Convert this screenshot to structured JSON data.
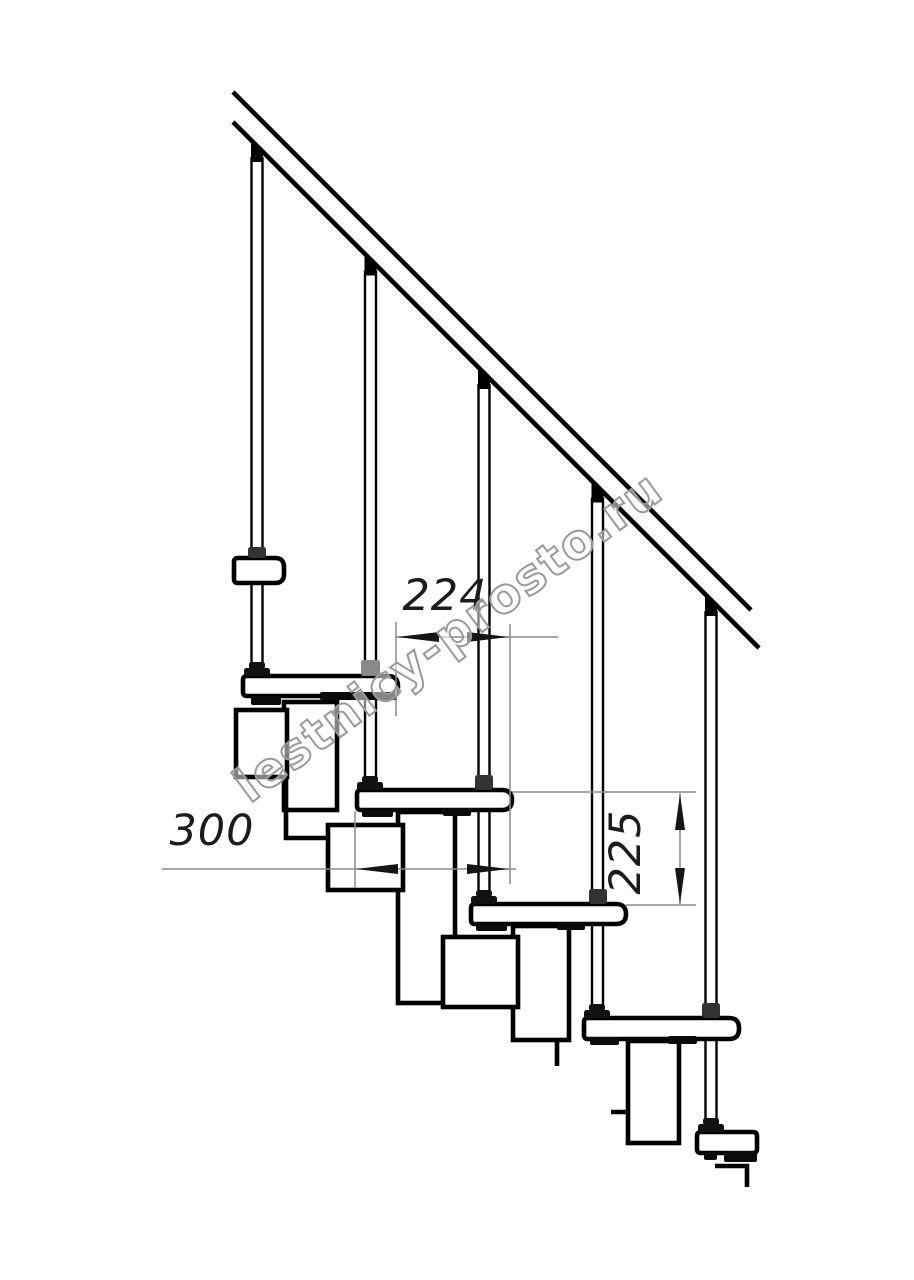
{
  "canvas": {
    "width": 914,
    "height": 1280,
    "background": "#ffffff",
    "ink": "#000000",
    "dim_line_color": "#8a8a8a",
    "dim_text_color": "#1c1c1c"
  },
  "watermark": {
    "text": "lestnicy-prosto.ru",
    "cx": 458,
    "cy": 650,
    "angle": -36.5,
    "font_size": 48,
    "stroke": "#9a9a9a",
    "fill": "#ffffff",
    "fill_opacity": 0.5
  },
  "handrail": {
    "upper_line": [
      233,
      92,
      751,
      610
    ],
    "lower_line": [
      233,
      122,
      759,
      648
    ],
    "stroke_width": 4.6
  },
  "balusters": [
    {
      "x": 257,
      "bottom": 676
    },
    {
      "x": 370.5,
      "bottom": 790
    },
    {
      "x": 484,
      "bottom": 904
    },
    {
      "x": 597.5,
      "bottom": 1018
    },
    {
      "x": 711,
      "bottom": 1132
    }
  ],
  "landing_plate": {
    "x": 234,
    "y": 558,
    "w": 50,
    "h": 25
  },
  "treads": [
    {
      "x": 243,
      "y": 676,
      "w": 155,
      "h": 20
    },
    {
      "x": 357,
      "y": 790,
      "w": 155,
      "h": 20
    },
    {
      "x": 471,
      "y": 904,
      "w": 155,
      "h": 20
    },
    {
      "x": 584,
      "y": 1018,
      "w": 155,
      "h": 21
    },
    {
      "x": 697,
      "y": 1132,
      "w": 60,
      "h": 21
    }
  ],
  "modules": [
    {
      "x": 284,
      "y": 702,
      "w": 53,
      "h": 108
    },
    {
      "x": 398,
      "y": 812,
      "w": 57,
      "h": 191
    },
    {
      "x": 513,
      "y": 926,
      "w": 56,
      "h": 114
    },
    {
      "x": 628,
      "y": 1041,
      "w": 51,
      "h": 102
    }
  ],
  "connectors": [
    {
      "x": 236,
      "y": 710,
      "w": 51,
      "h": 67
    },
    {
      "x": 328,
      "y": 825,
      "w": 75,
      "h": 65
    },
    {
      "x": 443,
      "y": 937,
      "w": 75,
      "h": 70
    }
  ],
  "polylines": [
    {
      "name": "upper-joint-step-line",
      "pts": [
        [
          286,
          777
        ],
        [
          286,
          838
        ],
        [
          330,
          838
        ]
      ]
    },
    {
      "name": "connector-3-left-line",
      "pts": [
        [
          557,
          1040
        ],
        [
          557,
          1066
        ]
      ]
    },
    {
      "name": "connector-3-bottom-line",
      "pts": [
        [
          630,
          1112
        ],
        [
          611,
          1112
        ]
      ]
    },
    {
      "name": "floor-step-line",
      "pts": [
        [
          715,
          1166
        ],
        [
          747,
          1166
        ],
        [
          747,
          1187
        ]
      ]
    }
  ],
  "tabs": [
    {
      "x": 251,
      "y": 696,
      "w": 30,
      "h": 9
    },
    {
      "x": 320,
      "y": 692,
      "w": 77,
      "h": 8
    },
    {
      "x": 362,
      "y": 809,
      "w": 31,
      "h": 8
    },
    {
      "x": 443,
      "y": 808,
      "w": 28,
      "h": 8
    },
    {
      "x": 476,
      "y": 923,
      "w": 31,
      "h": 8
    },
    {
      "x": 557,
      "y": 922,
      "w": 28,
      "h": 8
    },
    {
      "x": 590,
      "y": 1037,
      "w": 29,
      "h": 8
    },
    {
      "x": 668,
      "y": 1036,
      "w": 29,
      "h": 8
    },
    {
      "x": 704,
      "y": 1152,
      "w": 13,
      "h": 8
    },
    {
      "x": 724,
      "y": 1151,
      "w": 33,
      "h": 11
    }
  ],
  "collars": [
    {
      "kind": "collar",
      "x": 248,
      "y": 547,
      "w": 18,
      "h": 11,
      "c": "#333333"
    },
    {
      "kind": "flange",
      "x": 249,
      "y": 662,
      "w": 16,
      "h": 7,
      "c": "#111111"
    },
    {
      "kind": "flange",
      "x": 244,
      "y": 668,
      "w": 26,
      "h": 8,
      "c": "#111111"
    },
    {
      "kind": "collar",
      "x": 361,
      "y": 660,
      "w": 19,
      "h": 16,
      "c": "#898989"
    },
    {
      "kind": "flange",
      "x": 362,
      "y": 776,
      "w": 16,
      "h": 7,
      "c": "#111111"
    },
    {
      "kind": "flange",
      "x": 357,
      "y": 782,
      "w": 26,
      "h": 8,
      "c": "#111111"
    },
    {
      "kind": "collar",
      "x": 475,
      "y": 775,
      "w": 18,
      "h": 15,
      "c": "#333333"
    },
    {
      "kind": "flange",
      "x": 476,
      "y": 890,
      "w": 16,
      "h": 7,
      "c": "#111111"
    },
    {
      "kind": "flange",
      "x": 471,
      "y": 896,
      "w": 26,
      "h": 8,
      "c": "#111111"
    },
    {
      "kind": "collar",
      "x": 589,
      "y": 889,
      "w": 18,
      "h": 15,
      "c": "#333333"
    },
    {
      "kind": "flange",
      "x": 589,
      "y": 1004,
      "w": 16,
      "h": 7,
      "c": "#111111"
    },
    {
      "kind": "flange",
      "x": 584,
      "y": 1010,
      "w": 26,
      "h": 8,
      "c": "#111111"
    },
    {
      "kind": "collar",
      "x": 702,
      "y": 1003,
      "w": 18,
      "h": 15,
      "c": "#333333"
    },
    {
      "kind": "flange",
      "x": 703,
      "y": 1118,
      "w": 16,
      "h": 7,
      "c": "#111111"
    },
    {
      "kind": "flange",
      "x": 698,
      "y": 1124,
      "w": 26,
      "h": 8,
      "c": "#111111"
    }
  ],
  "dimensions": {
    "d224": {
      "label": "224",
      "label_pos": [
        445,
        610
      ],
      "ext_lines": [
        [
          396,
          622,
          396,
          716
        ],
        [
          510,
          624,
          510,
          884
        ]
      ],
      "dim_line": [
        396,
        637,
        558,
        637
      ],
      "arrows": [
        {
          "tip": [
            397,
            637
          ],
          "dir": "left"
        },
        {
          "tip": [
            509,
            637
          ],
          "dir": "right"
        }
      ]
    },
    "d300": {
      "label": "300",
      "label_pos": [
        212,
        845
      ],
      "ext_lines": [
        [
          355,
          811,
          355,
          888
        ]
      ],
      "dim_line": [
        162,
        869,
        516,
        869
      ],
      "arrows": [
        {
          "tip": [
            356,
            869
          ],
          "dir": "left"
        },
        {
          "tip": [
            509,
            869
          ],
          "dir": "right"
        }
      ]
    },
    "d225": {
      "label": "225",
      "label_pos": [
        640,
        852
      ],
      "label_rotation": -90,
      "ext_lines": [
        [
          512,
          792,
          696,
          792
        ],
        [
          626,
          905,
          696,
          905
        ]
      ],
      "dim_line": [
        680,
        793,
        680,
        904
      ],
      "arrows": [
        {
          "tip": [
            680,
            794
          ],
          "dir": "up"
        },
        {
          "tip": [
            680,
            904
          ],
          "dir": "down"
        }
      ]
    }
  }
}
